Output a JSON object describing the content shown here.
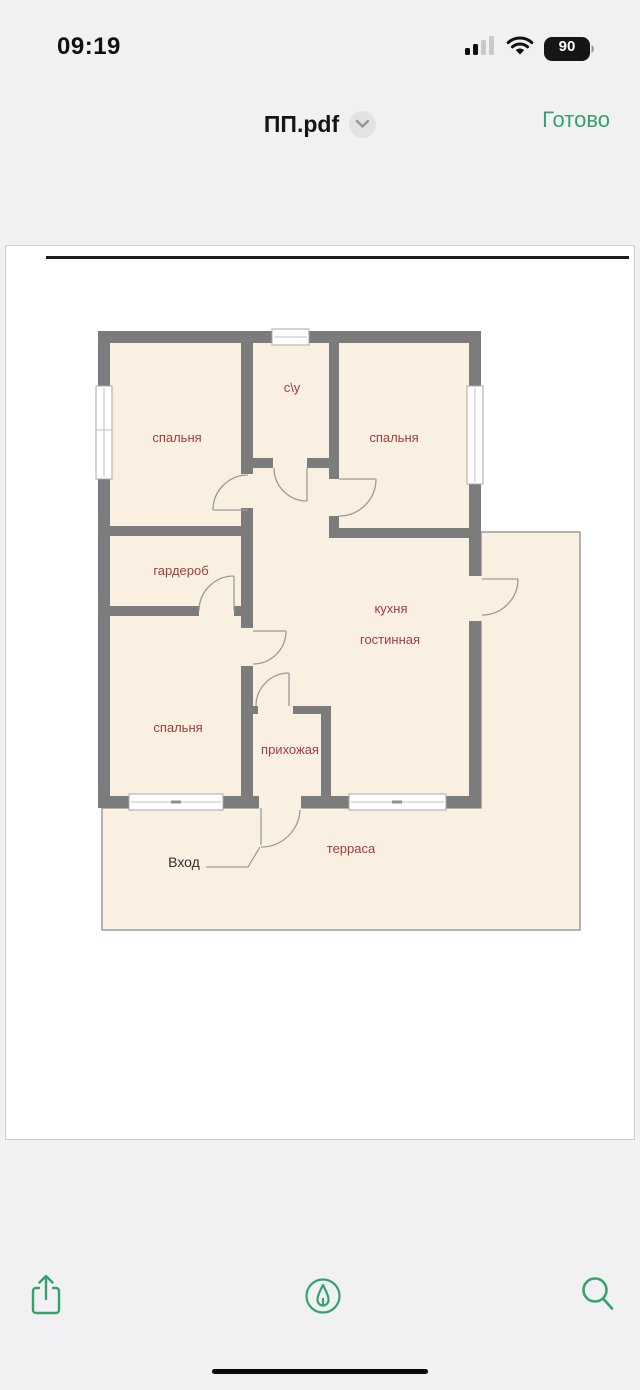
{
  "status_bar": {
    "time": "09:19",
    "battery_percent": "90",
    "icons": [
      "cellular-signal-icon",
      "wifi-icon",
      "battery-icon"
    ]
  },
  "nav_bar": {
    "title": "ПП.pdf",
    "title_menu_icon": "chevron-down-icon",
    "done_label": "Готово"
  },
  "document": {
    "type": "pdf-page",
    "floor_plan": {
      "labels": {
        "bedroom_top_left": "спальня",
        "bathroom": "с\\у",
        "bedroom_top_right": "спальня",
        "wardrobe": "гардероб",
        "kitchen": "кухня",
        "living": "гостинная",
        "bedroom_bottom_left": "спальня",
        "hallway": "прихожая",
        "terrace": "терраса",
        "entrance": "Вход"
      },
      "colors": {
        "wall": "#7c7c7c",
        "room_fill": "#faf0e2",
        "room_label": "#a23c3c",
        "entrance_label": "#2f2f2f"
      }
    }
  },
  "toolbar": {
    "accent_color": "#35a26e",
    "icons": [
      "share-icon",
      "markup-icon",
      "search-icon"
    ]
  }
}
